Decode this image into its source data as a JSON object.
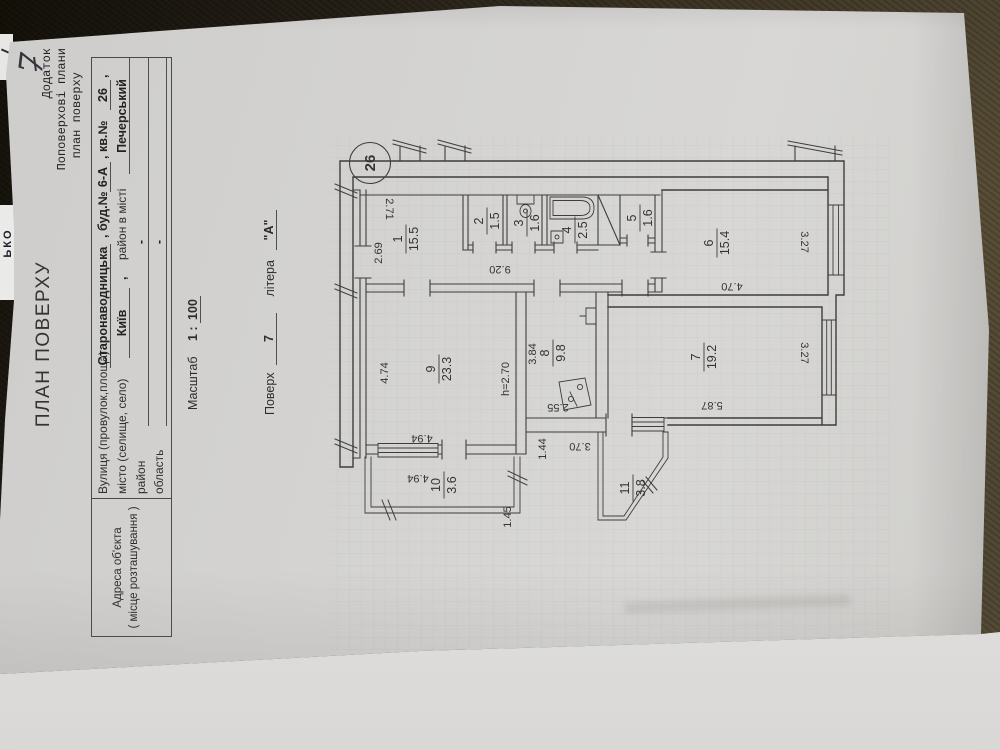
{
  "doc": {
    "page_number": "7",
    "annex": {
      "line1": "Додаток",
      "line2": "Поповерхові плани",
      "line3": "план поверху"
    },
    "title": "ПЛАН ПОВЕРХУ",
    "address": {
      "header1": "Адреса об'єкта",
      "header2": "( місце розташування )",
      "street_label": "Вулиця (провулок,площа)",
      "street_value": "Старонаводницька",
      "house_pre": ", буд.№",
      "house_value": "6-А",
      "apt_pre": ", кв.№",
      "apt_value": "26",
      "apt_tail": ",",
      "city_label": "місто (селище, село)",
      "city_value": "Київ",
      "city_sep": ",",
      "district_label": "район в місті",
      "district_value": "Печерський",
      "raion_label": "район",
      "raion_value": "-",
      "oblast_label": "область",
      "oblast_value": "-"
    },
    "scale": {
      "label": "Масштаб",
      "pre": "1 :",
      "value": "100"
    },
    "floor": {
      "label": "Поверх",
      "value": "7",
      "letter_label": "літера",
      "letter_value": "\"А\""
    },
    "edge_fragment": "ЬКО"
  },
  "plan": {
    "unit_number": "26",
    "height_note": "h=2.70",
    "rooms": {
      "r1": {
        "num": "1",
        "area": "15.5"
      },
      "r2": {
        "num": "2",
        "area": "1.5"
      },
      "r3": {
        "num": "3",
        "area": "1.6"
      },
      "r4": {
        "num": "4",
        "area": "2.5"
      },
      "r5": {
        "num": "5",
        "area": "1.6"
      },
      "r6": {
        "num": "6",
        "area": "15.4"
      },
      "r7": {
        "num": "7",
        "area": "19.2"
      },
      "r8": {
        "num": "8",
        "area": "9.8"
      },
      "r9": {
        "num": "9",
        "area": "23.3"
      },
      "r10": {
        "num": "10",
        "area": "3.6"
      },
      "r11": {
        "num": "11",
        "area": "3.8"
      }
    },
    "dims": {
      "d269": "2.69",
      "d271": "2.71",
      "d920": "9.20",
      "d474": "4.74",
      "d494a": "4.94",
      "d494b": "4.94",
      "d145": "1.45",
      "d384": "3.84",
      "d255": "2.55",
      "d144": "1.44",
      "d370": "3.70",
      "d587": "5.87",
      "d327a": "3.27",
      "d470": "4.70",
      "d327b": "3.27"
    }
  }
}
